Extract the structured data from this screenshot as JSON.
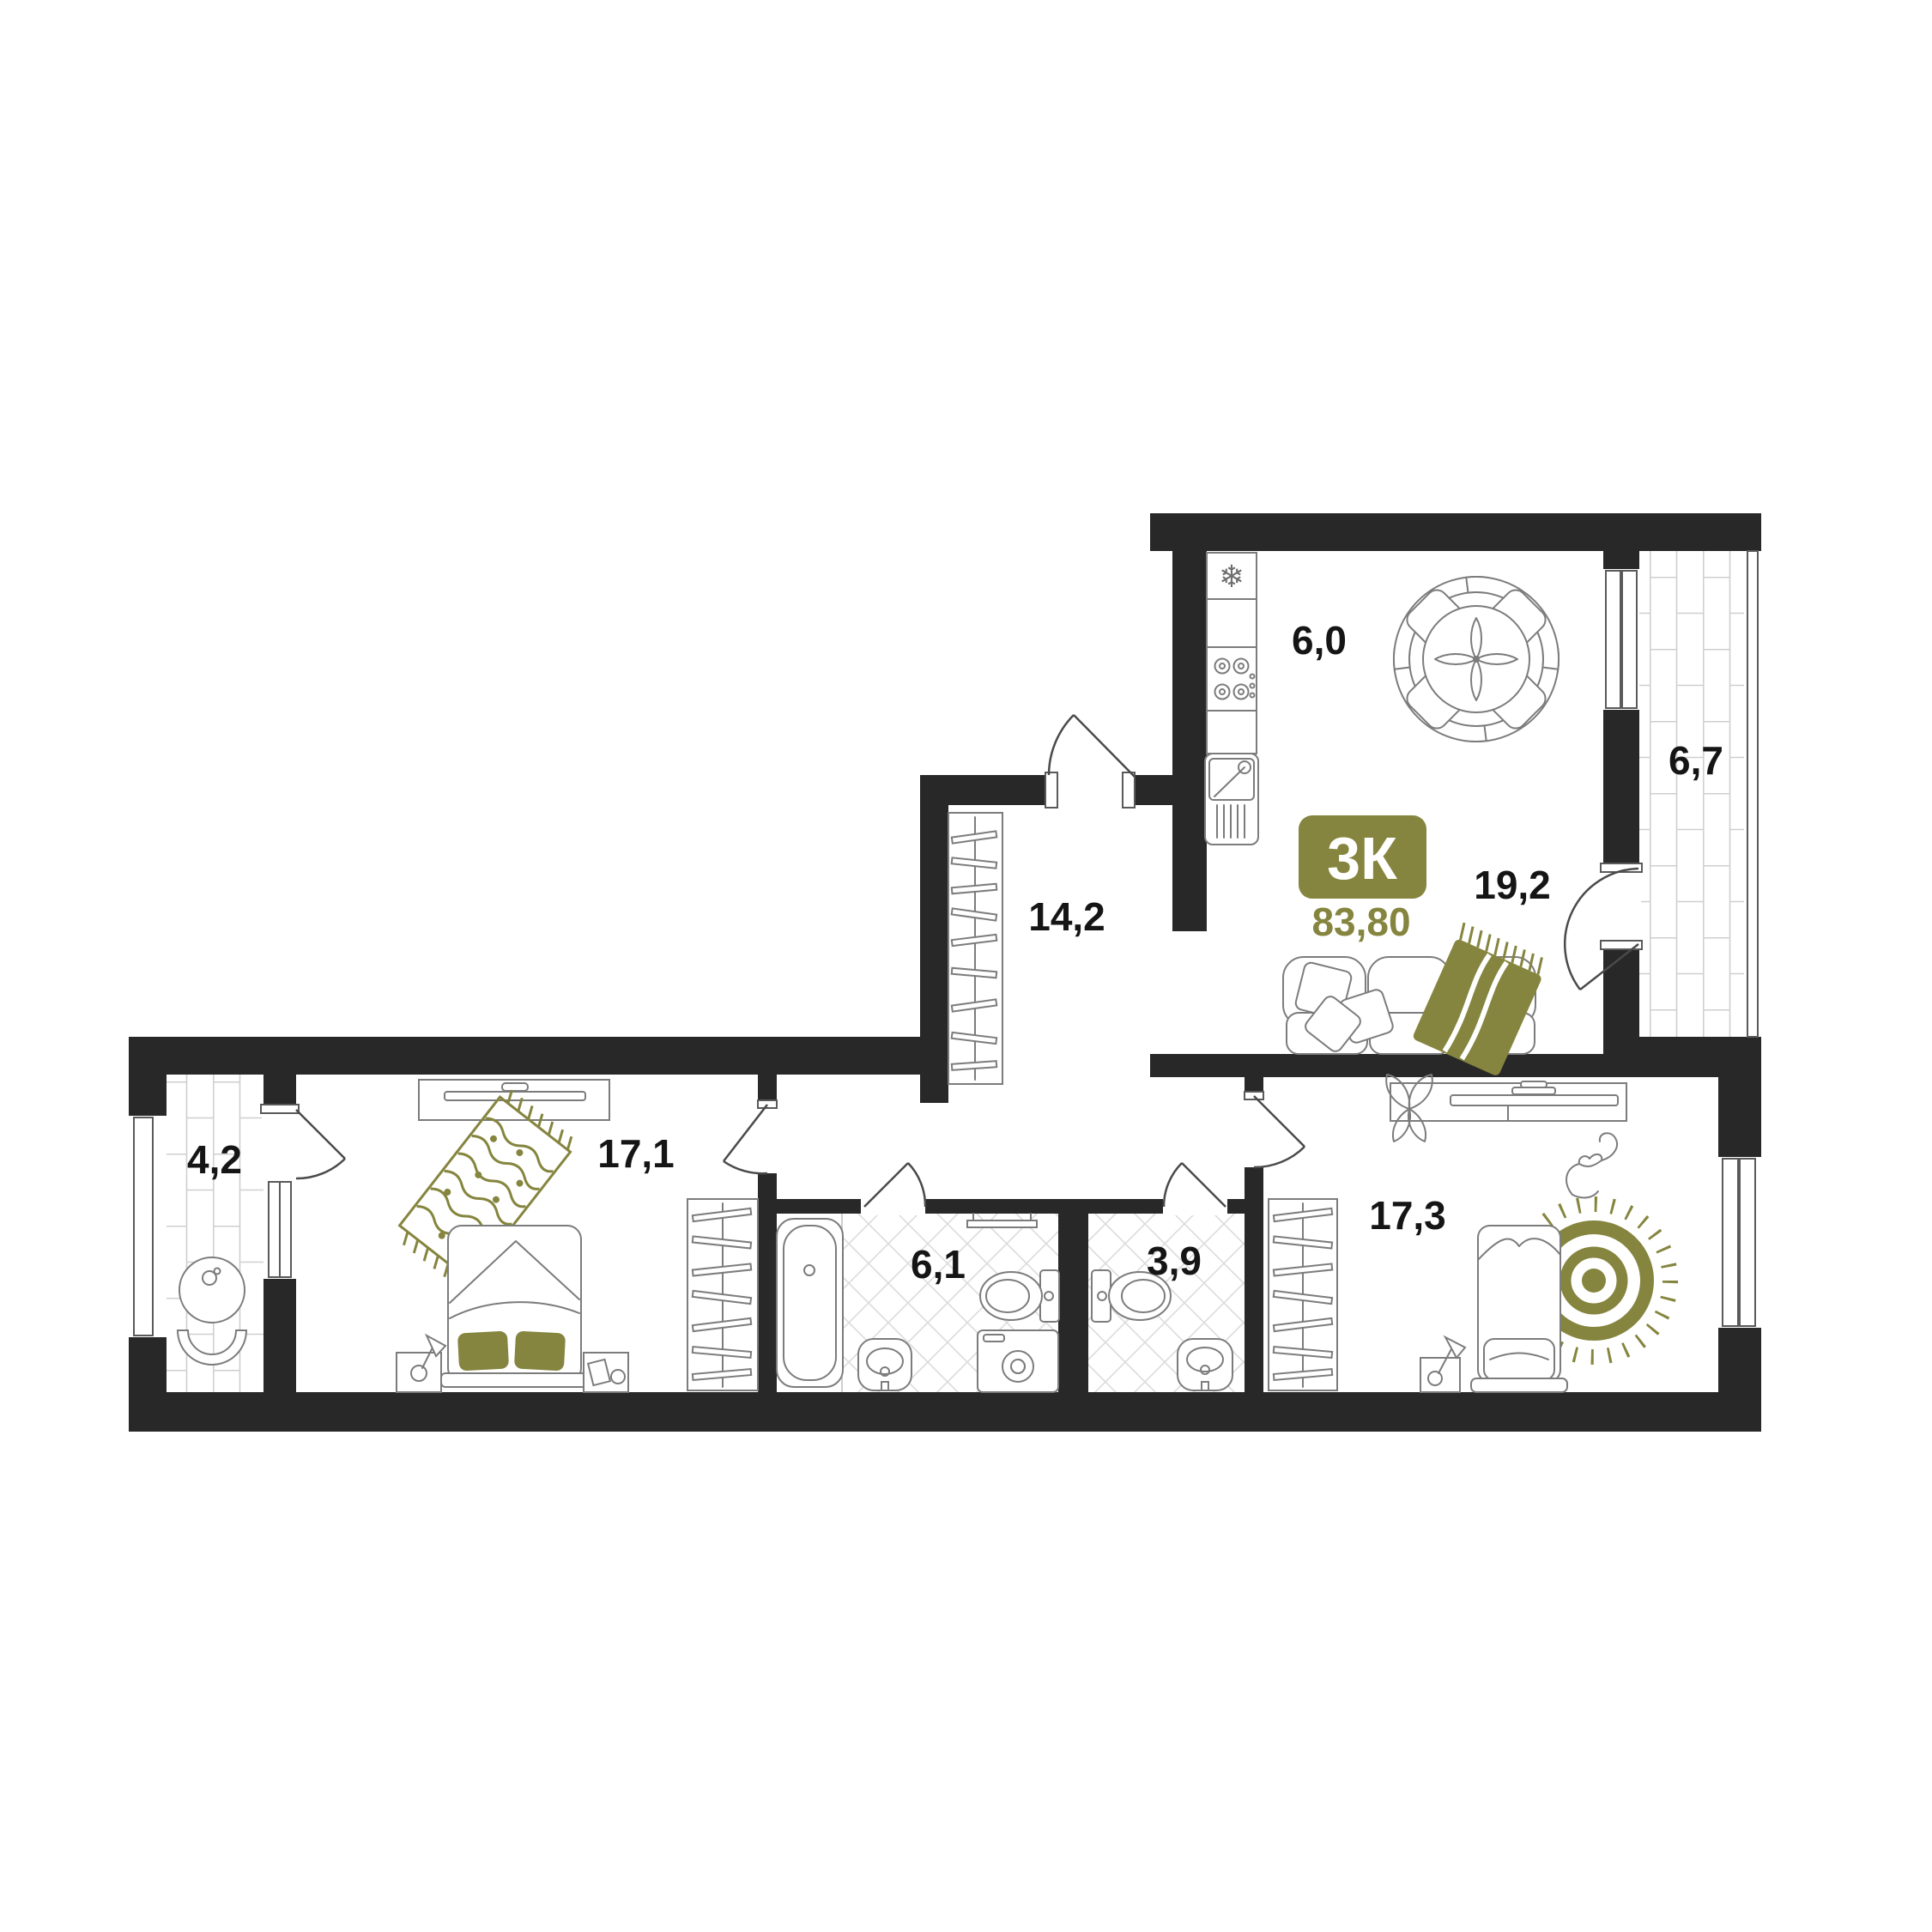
{
  "badge": {
    "type": "3К",
    "total_area": "83,80"
  },
  "rooms": {
    "kitchen": {
      "name": "kitchen",
      "area": "6,0"
    },
    "loggia_right": {
      "name": "loggia-right",
      "area": "6,7"
    },
    "living": {
      "name": "living-room",
      "area": "19,2"
    },
    "hallway": {
      "name": "hallway",
      "area": "14,2"
    },
    "loggia_left": {
      "name": "loggia-left",
      "area": "4,2"
    },
    "bedroom_left": {
      "name": "bedroom-left",
      "area": "17,1"
    },
    "bathroom": {
      "name": "bathroom",
      "area": "6,1"
    },
    "wc": {
      "name": "wc",
      "area": "3,9"
    },
    "bedroom_right": {
      "name": "bedroom-right",
      "area": "17,3"
    }
  },
  "colors": {
    "wall": "#282828",
    "accent_olive": "#85853f",
    "furniture_line": "#7c7c7c",
    "tile_line": "#dcdcdc",
    "label_text": "#151515"
  },
  "icons": {
    "fridge": "snowflake-icon"
  }
}
